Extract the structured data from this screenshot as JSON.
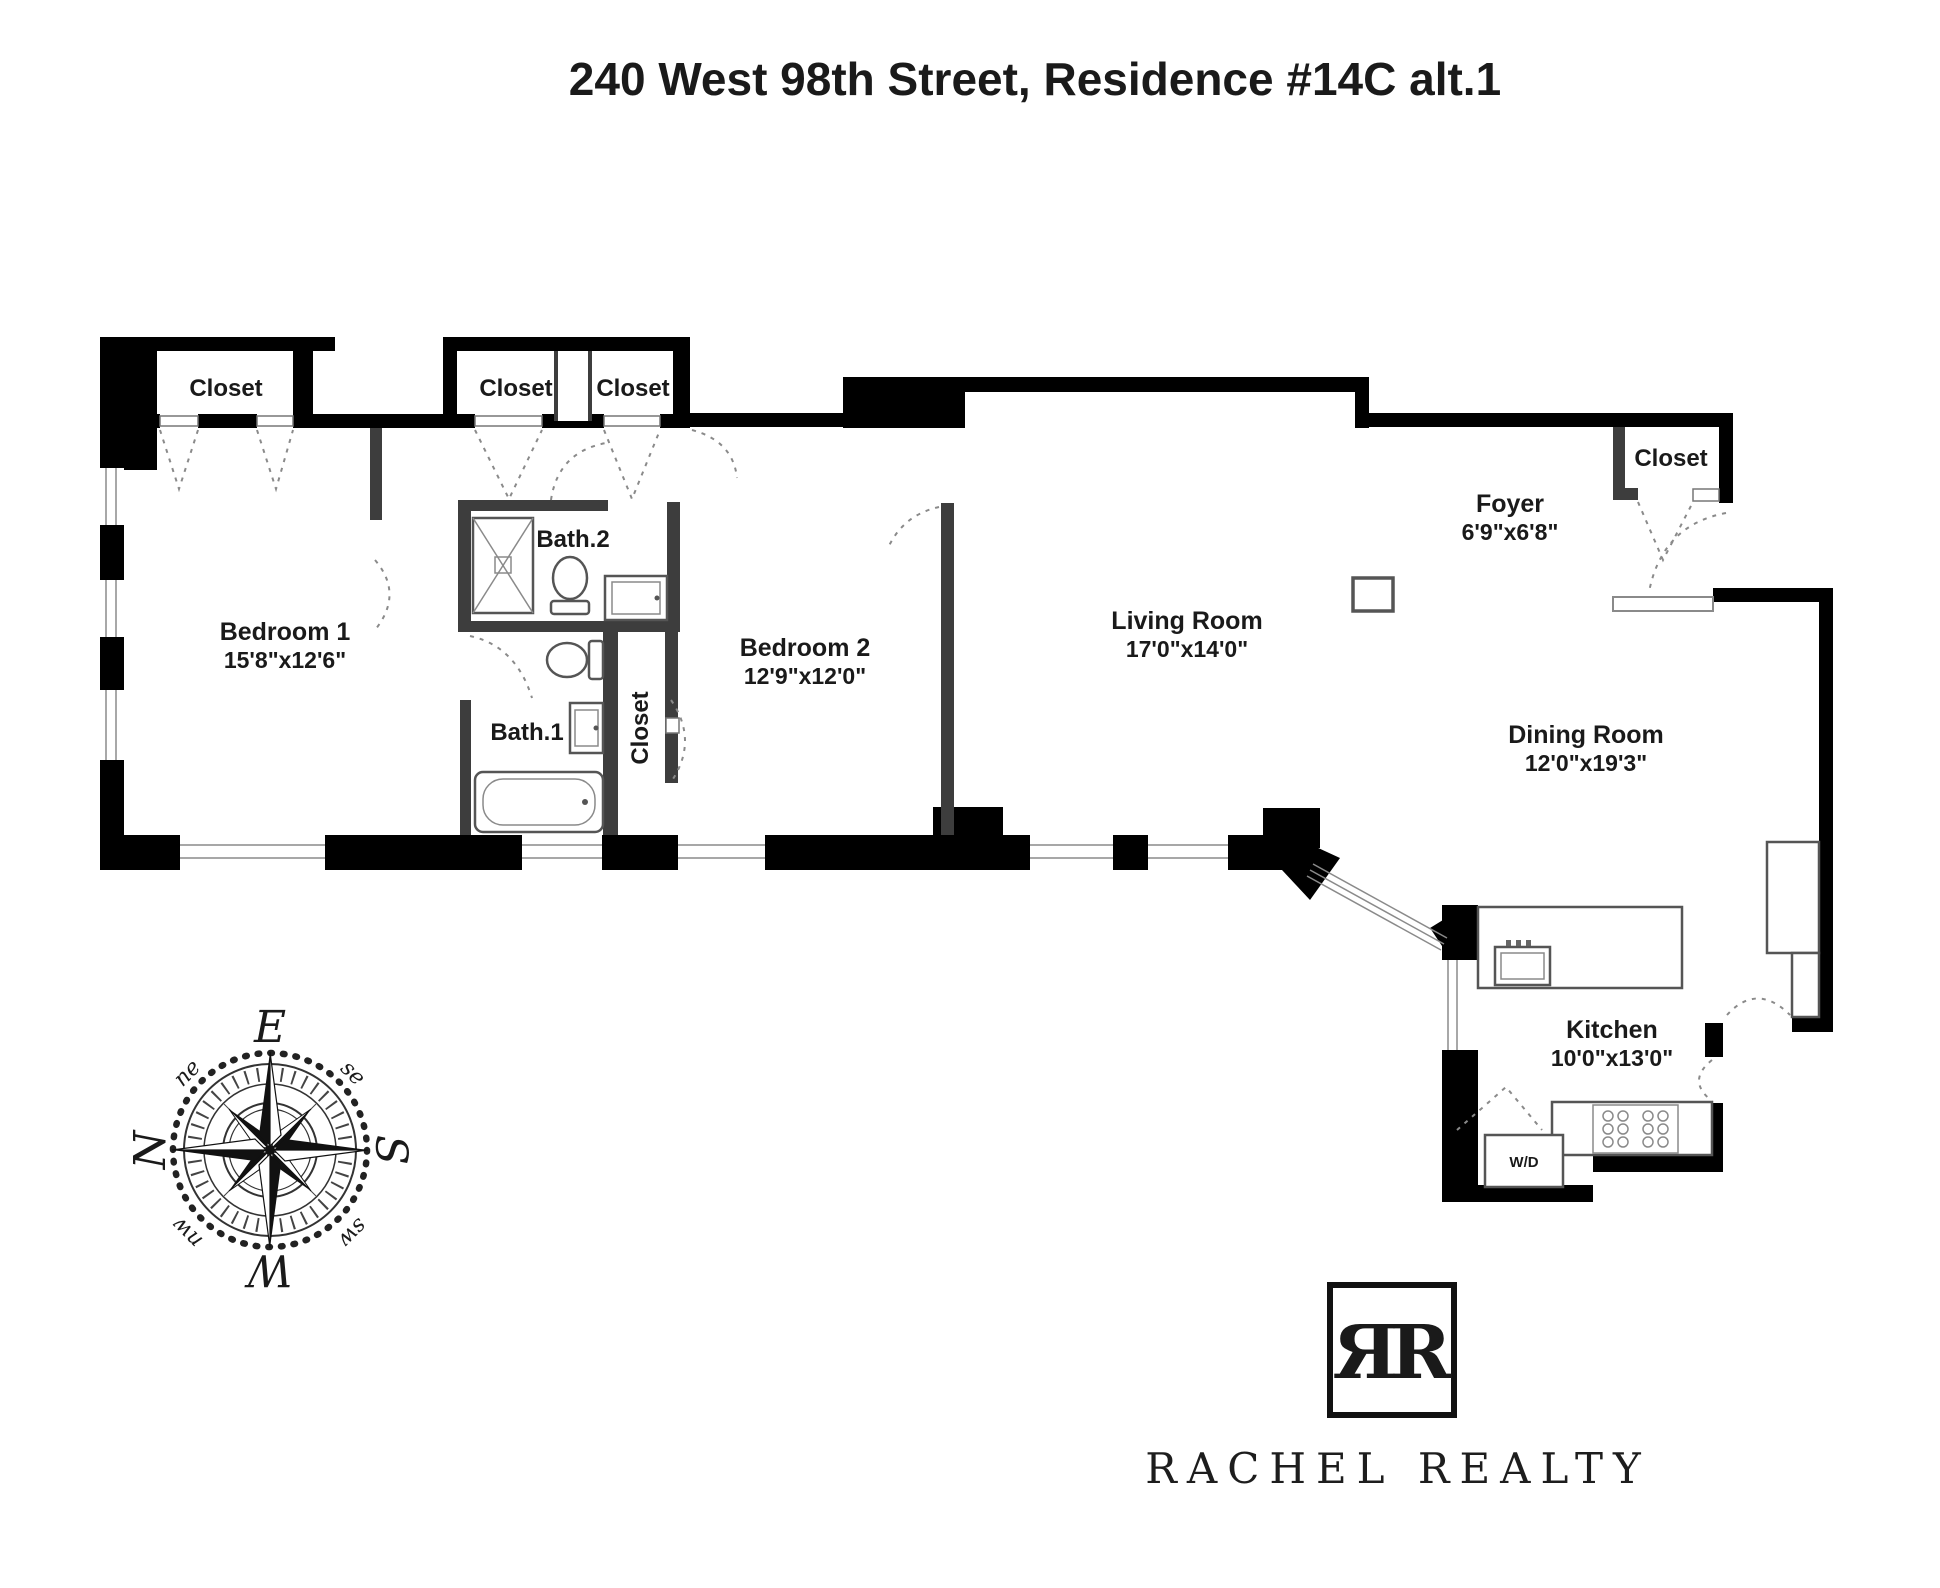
{
  "title": "240 West 98th Street, Residence #14C alt.1",
  "rooms": {
    "bedroom1": {
      "name": "Bedroom 1",
      "dims": "15'8\"x12'6\""
    },
    "bedroom2": {
      "name": "Bedroom 2",
      "dims": "12'9\"x12'0\""
    },
    "living_room": {
      "name": "Living Room",
      "dims": "17'0\"x14'0\""
    },
    "dining_room": {
      "name": "Dining Room",
      "dims": "12'0\"x19'3\""
    },
    "kitchen": {
      "name": "Kitchen",
      "dims": "10'0\"x13'0\""
    },
    "foyer": {
      "name": "Foyer",
      "dims": "6'9\"x6'8\""
    },
    "bath1": {
      "name": "Bath.1"
    },
    "bath2": {
      "name": "Bath.2"
    }
  },
  "closets": {
    "bedroom1_closet": "Closet",
    "hall_closet_left": "Closet",
    "hall_closet_right": "Closet",
    "hallway_closet": "Closet",
    "foyer_closet": "Closet"
  },
  "appliances": {
    "washer_dryer": "W/D"
  },
  "compass": {
    "north": "N",
    "east": "E",
    "south": "S",
    "west": "W",
    "northeast": "ne",
    "southeast": "se",
    "southwest": "sw",
    "northwest": "nw"
  },
  "branding": {
    "monogram": "ЯR",
    "agency_name": "RACHEL REALTY"
  },
  "colors": {
    "walls": "#000000",
    "interior_walls": "#3d3d3d",
    "fixtures": "#555555",
    "door_swings": "#8a8a8a",
    "text": "#1a1a1a",
    "background": "#ffffff"
  }
}
